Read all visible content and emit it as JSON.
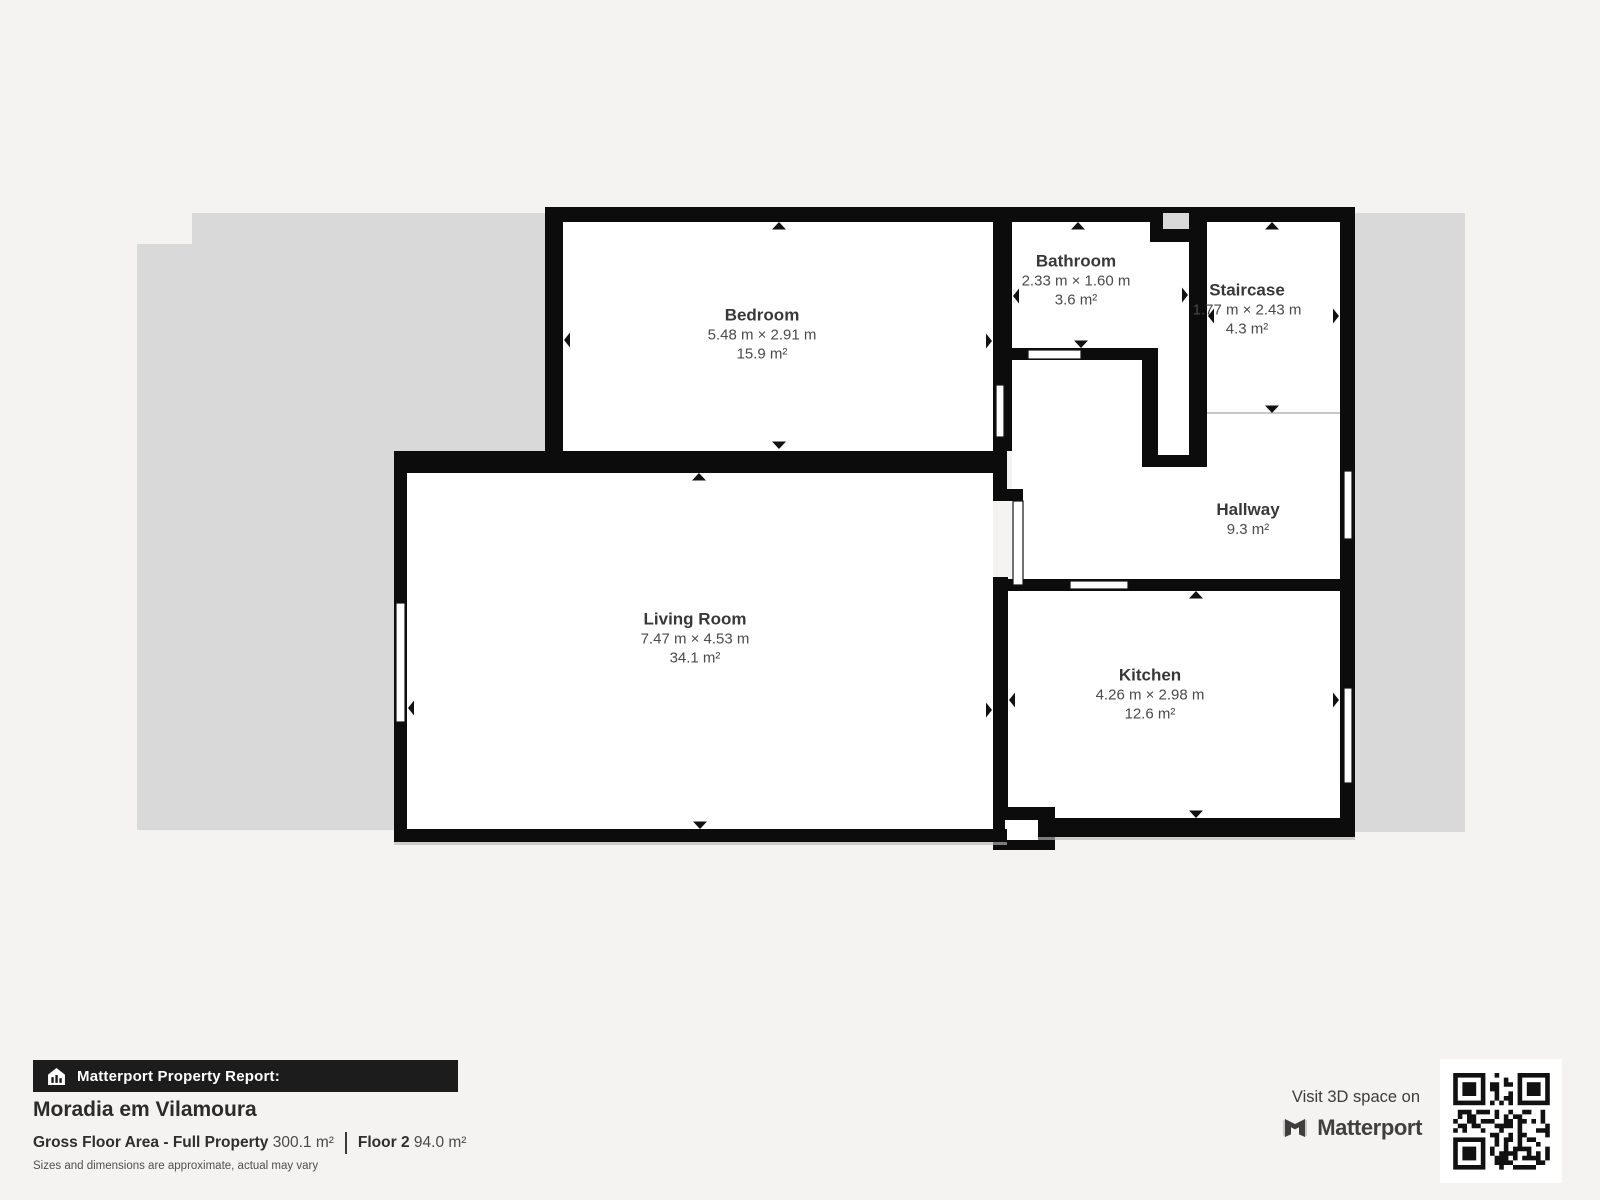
{
  "plan": {
    "rooms": [
      {
        "id": "bedroom",
        "name": "Bedroom",
        "dimensions": "5.48 m × 2.91 m",
        "area": "15.9 m²"
      },
      {
        "id": "bathroom",
        "name": "Bathroom",
        "dimensions": "2.33 m × 1.60 m",
        "area": "3.6 m²"
      },
      {
        "id": "staircase",
        "name": "Staircase",
        "dimensions": "1.77 m × 2.43 m",
        "area": "4.3 m²"
      },
      {
        "id": "hallway",
        "name": "Hallway",
        "dimensions": "",
        "area": "9.3 m²"
      },
      {
        "id": "living_room",
        "name": "Living Room",
        "dimensions": "7.47 m × 4.53 m",
        "area": "34.1 m²"
      },
      {
        "id": "kitchen",
        "name": "Kitchen",
        "dimensions": "4.26 m × 2.98 m",
        "area": "12.6 m²"
      }
    ],
    "colors": {
      "wall": "#0c0c0c",
      "floor": "#ffffff",
      "outside_area": "#d9d9d9",
      "page_background": "#f4f3f1"
    }
  },
  "footer": {
    "report_label": "Matterport Property Report:",
    "property_name": "Moradia em Vilamoura",
    "gross_floor_area_label": "Gross Floor Area - Full Property",
    "gross_floor_area_value": "300.1 m²",
    "floor_label": "Floor 2",
    "floor_value": "94.0 m²",
    "disclaimer": "Sizes and dimensions are approximate, actual may vary",
    "visit_label": "Visit 3D space on",
    "brand": "Matterport"
  },
  "icons": {
    "report_bar_icon": "house-report-icon",
    "brand_icon": "matterport-logo-icon",
    "qr": "qr-code",
    "plan_markers": [
      "dimension-arrow",
      "door-leaf",
      "window"
    ]
  }
}
